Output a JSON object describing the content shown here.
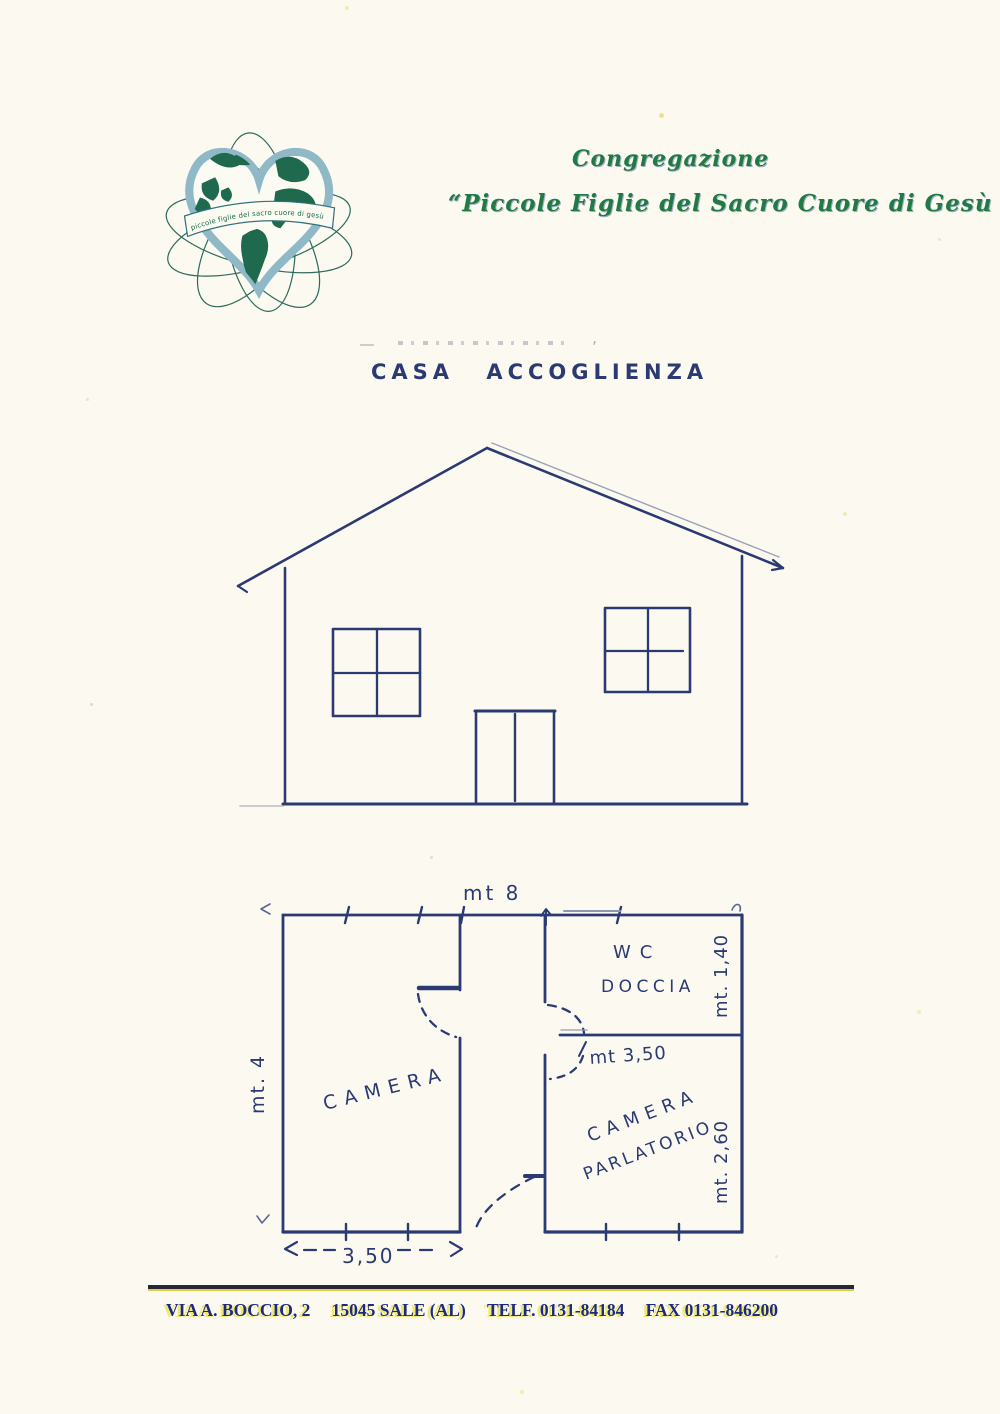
{
  "header": {
    "congregation_line1": "Congregazione",
    "congregation_line2": "“Piccole Figlie del Sacro Cuore di Gesù",
    "logo_banner": "piccole figlie del sacro cuore di gesù"
  },
  "title": "CASA ACCOGLIENZA",
  "floor_plan": {
    "width_label": "mt 8",
    "height_label": "mt. 4",
    "camera_label": "CAMERA",
    "wc_label": "WC",
    "doccia_label": "DOCCIA",
    "mid_dim_label": "mt 3,50",
    "parlatorio_line1": "CAMERA",
    "parlatorio_line2": "PARLATORIO",
    "wc_width_label": "mt. 1,40",
    "parlatorio_width_label": "mt. 2,60",
    "camera_width_label": "3,50"
  },
  "footer": {
    "address": "VIA A. BOCCIO, 2",
    "city": "15045 SALE (AL)",
    "phone": "TELF. 0131-84184",
    "fax": "FAX 0131-846200"
  },
  "colors": {
    "paper": "#fcfaf0",
    "ink_blue": "#2c3a74",
    "script_green": "#1f7a44",
    "logo_teal": "#2f6b5e",
    "footer_navy": "#1b2b7e",
    "highlight_yellow": "#eee24a"
  }
}
